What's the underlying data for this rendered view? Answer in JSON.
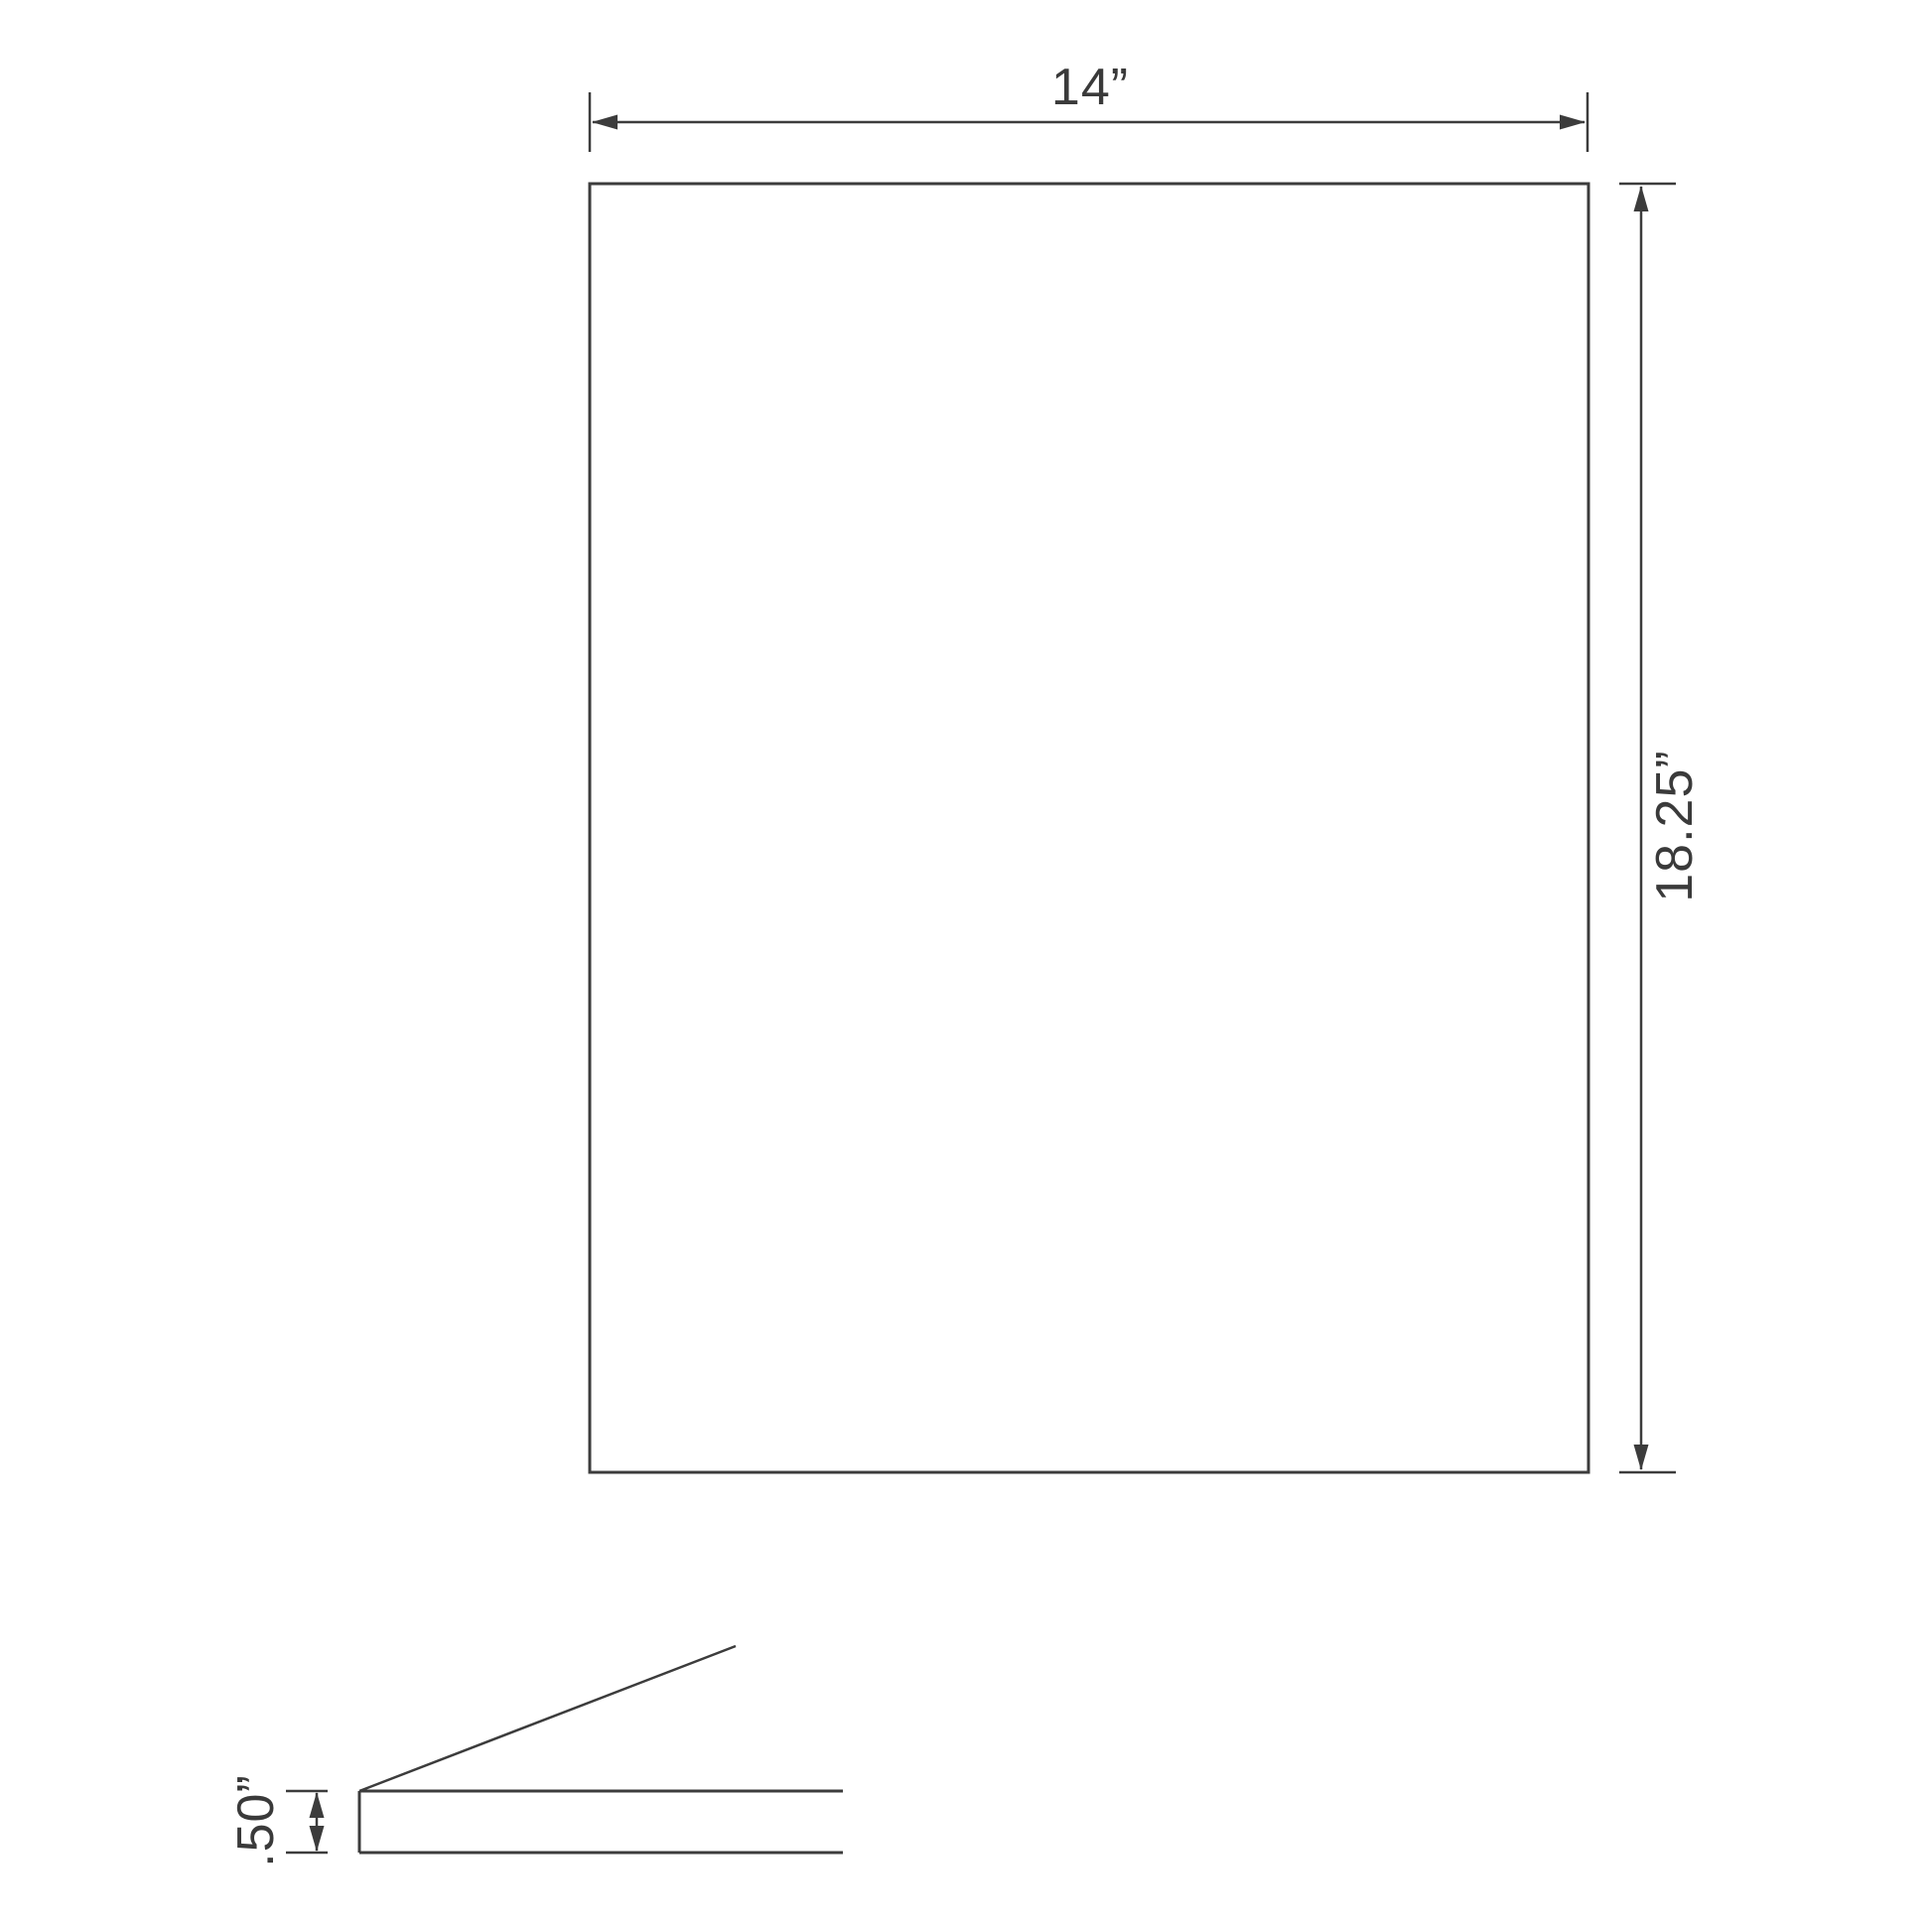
{
  "drawing": {
    "background": "#ffffff",
    "line_color": "#3c3c3c",
    "text_color": "#3a3a3a",
    "front_view": {
      "width_label": "14”",
      "height_label": "18.25”"
    },
    "side_view": {
      "thickness_label": ".50”"
    }
  }
}
